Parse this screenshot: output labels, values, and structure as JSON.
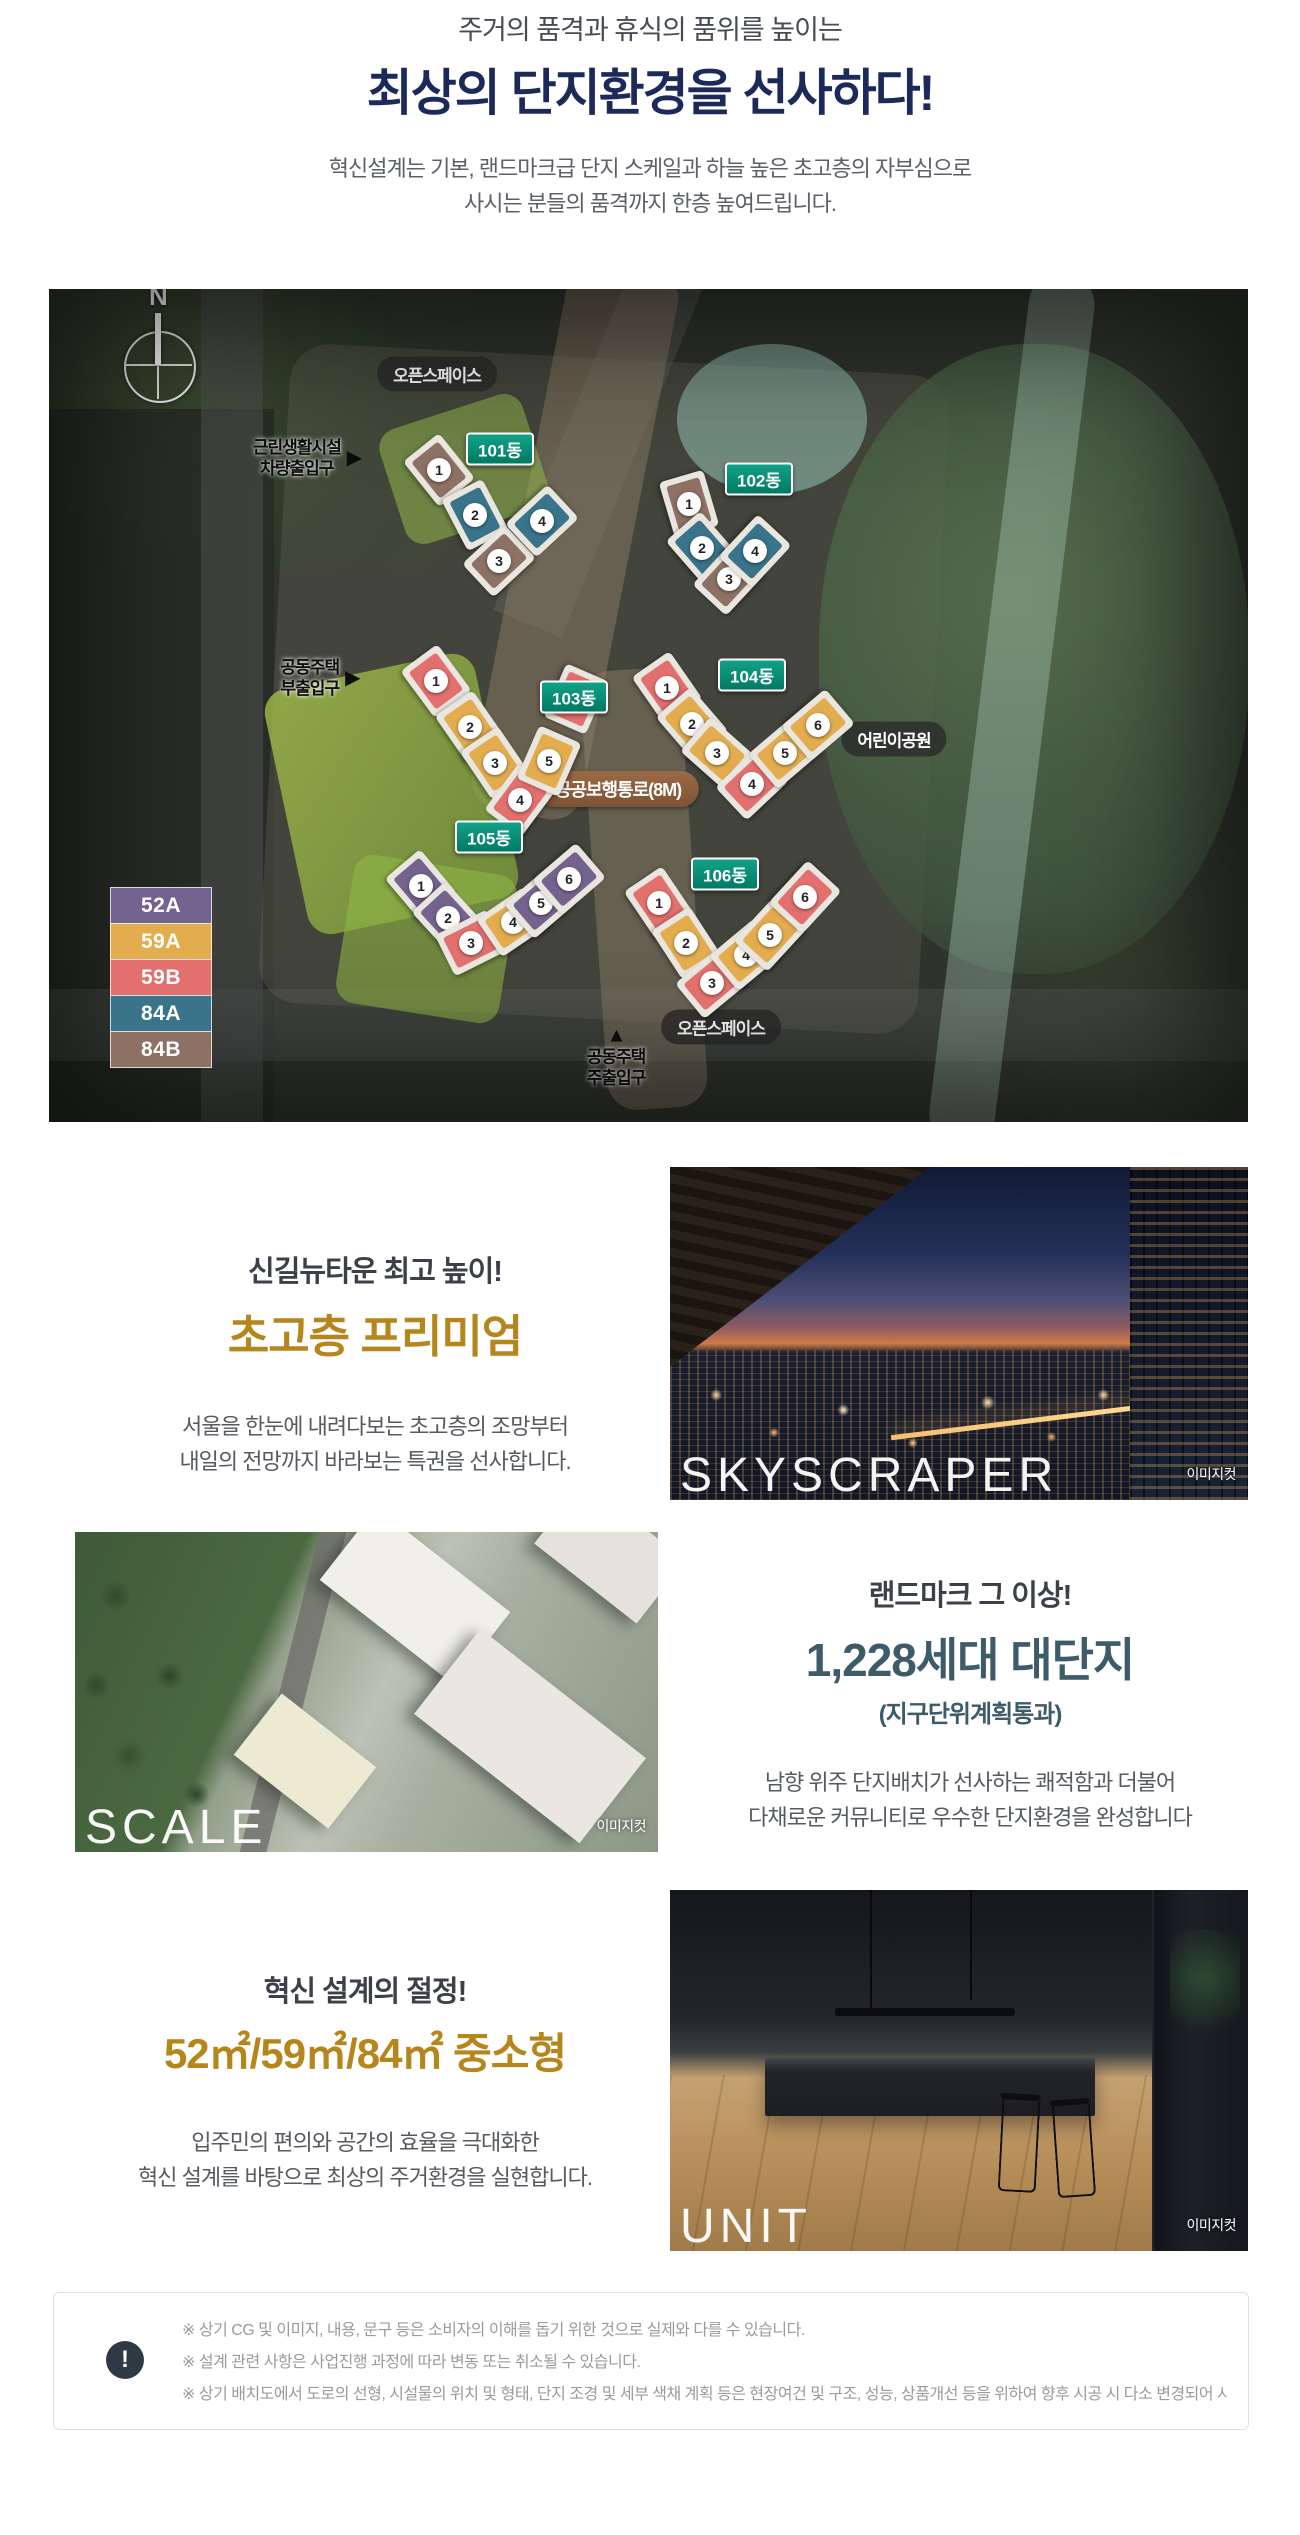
{
  "header": {
    "eyebrow": "주거의 품격과 휴식의 품위를 높이는",
    "title": "최상의 단지환경을 선사하다!",
    "desc_line1": "혁신설계는 기본, 랜드마크급 단지 스케일과 하늘 높은 초고층의 자부심으로",
    "desc_line2": "사시는 분들의 품격까지 한층 높여드립니다."
  },
  "siteplan": {
    "compass_label": "N",
    "labels": {
      "open_space_top": "오픈스페이스",
      "retail_entrance_line1": "근린생활시설",
      "retail_entrance_line2": "차량출입구",
      "side_entrance_line1": "공동주택",
      "side_entrance_line2": "부출입구",
      "public_walkway": "공공보행통로(8M)",
      "children_park": "어린이공원",
      "open_space_bottom": "오픈스페이스",
      "main_entrance_line1": "공동주택",
      "main_entrance_line2": "주출입구",
      "arrow_right": "▶",
      "arrow_up": "▲"
    },
    "unit_type_colors": {
      "52A": "#75638f",
      "59A": "#e3ac4f",
      "59B": "#e2706e",
      "84A": "#39748a",
      "84B": "#8c7164"
    },
    "legend": [
      {
        "label": "52A",
        "color": "#75638f"
      },
      {
        "label": "59A",
        "color": "#e3ac4f"
      },
      {
        "label": "59B",
        "color": "#e2706e"
      },
      {
        "label": "84A",
        "color": "#39748a"
      },
      {
        "label": "84B",
        "color": "#8c7164"
      }
    ],
    "buildings": [
      {
        "name": "101동",
        "units": [
          {
            "no": "1",
            "type": "84B"
          },
          {
            "no": "2",
            "type": "84A"
          },
          {
            "no": "3",
            "type": "84B"
          },
          {
            "no": "4",
            "type": "84A"
          }
        ]
      },
      {
        "name": "102동",
        "units": [
          {
            "no": "1",
            "type": "84B"
          },
          {
            "no": "2",
            "type": "84A"
          },
          {
            "no": "3",
            "type": "84B"
          },
          {
            "no": "4",
            "type": "84A"
          }
        ]
      },
      {
        "name": "103동",
        "units": [
          {
            "no": "1",
            "type": "59B"
          },
          {
            "no": "2",
            "type": "59A"
          },
          {
            "no": "3",
            "type": "59A"
          },
          {
            "no": "4",
            "type": "59B"
          },
          {
            "no": "5",
            "type": "59A"
          },
          {
            "no": "6",
            "type": "59B"
          }
        ]
      },
      {
        "name": "104동",
        "units": [
          {
            "no": "1",
            "type": "59B"
          },
          {
            "no": "2",
            "type": "59A"
          },
          {
            "no": "3",
            "type": "59A"
          },
          {
            "no": "4",
            "type": "59B"
          },
          {
            "no": "5",
            "type": "59A"
          },
          {
            "no": "6",
            "type": "59A"
          }
        ]
      },
      {
        "name": "105동",
        "units": [
          {
            "no": "1",
            "type": "52A"
          },
          {
            "no": "2",
            "type": "52A"
          },
          {
            "no": "3",
            "type": "59B"
          },
          {
            "no": "4",
            "type": "59A"
          },
          {
            "no": "5",
            "type": "52A"
          },
          {
            "no": "6",
            "type": "52A"
          }
        ]
      },
      {
        "name": "106동",
        "units": [
          {
            "no": "1",
            "type": "59B"
          },
          {
            "no": "2",
            "type": "59A"
          },
          {
            "no": "3",
            "type": "59B"
          },
          {
            "no": "4",
            "type": "59A"
          },
          {
            "no": "5",
            "type": "59A"
          },
          {
            "no": "6",
            "type": "59B"
          }
        ]
      }
    ]
  },
  "sections": {
    "skyscraper": {
      "eyebrow": "신길뉴타운 최고 높이!",
      "title": "초고층 프리미엄",
      "desc1": "서울을 한눈에 내려다보는 초고층의 조망부터",
      "desc2": "내일의 전망까지 바라보는 특권을 선사합니다.",
      "overlay": "SKYSCRAPER",
      "badge": "이미지컷"
    },
    "scale": {
      "eyebrow": "랜드마크 그 이상!",
      "title": "1,228세대 대단지",
      "subtitle": "(지구단위계획통과)",
      "desc1": "남향 위주 단지배치가 선사하는 쾌적함과 더불어",
      "desc2": "다채로운 커뮤니티로 우수한 단지환경을 완성합니다",
      "overlay": "SCALE",
      "badge": "이미지컷"
    },
    "unit": {
      "eyebrow": "혁신 설계의 절정!",
      "title": "52㎡/59㎡/84㎡ 중소형",
      "desc1": "입주민의 편의와 공간의 효율을 극대화한",
      "desc2": "혁신 설계를 바탕으로 최상의 주거환경을 실현합니다.",
      "overlay": "UNIT",
      "badge": "이미지컷"
    }
  },
  "disclaimer": {
    "icon": "!",
    "lines": [
      "※ 상기 CG 및 이미지, 내용, 문구 등은 소비자의 이해를 돕기 위한 것으로 실제와 다를 수 있습니다.",
      "※ 설계 관련 사항은 사업진행 과정에 따라 변동 또는 취소될 수 있습니다.",
      "※ 상기 배치도에서 도로의 선형, 시설물의 위치 및 형태, 단지 조경 및 세부 색채 계획 등은 현장여건 및 구조, 성능, 상품개선 등을 위하여 향후 시공 시 다소 변경되어 시공될 수 있습니다."
    ]
  },
  "colors": {
    "title_navy": "#1c2a5a",
    "accent_gold": "#b5861b",
    "accent_teal": "#3e5b6a",
    "dong_pill_green": "#089179",
    "walkway_pill_brown": "#8f6240"
  }
}
